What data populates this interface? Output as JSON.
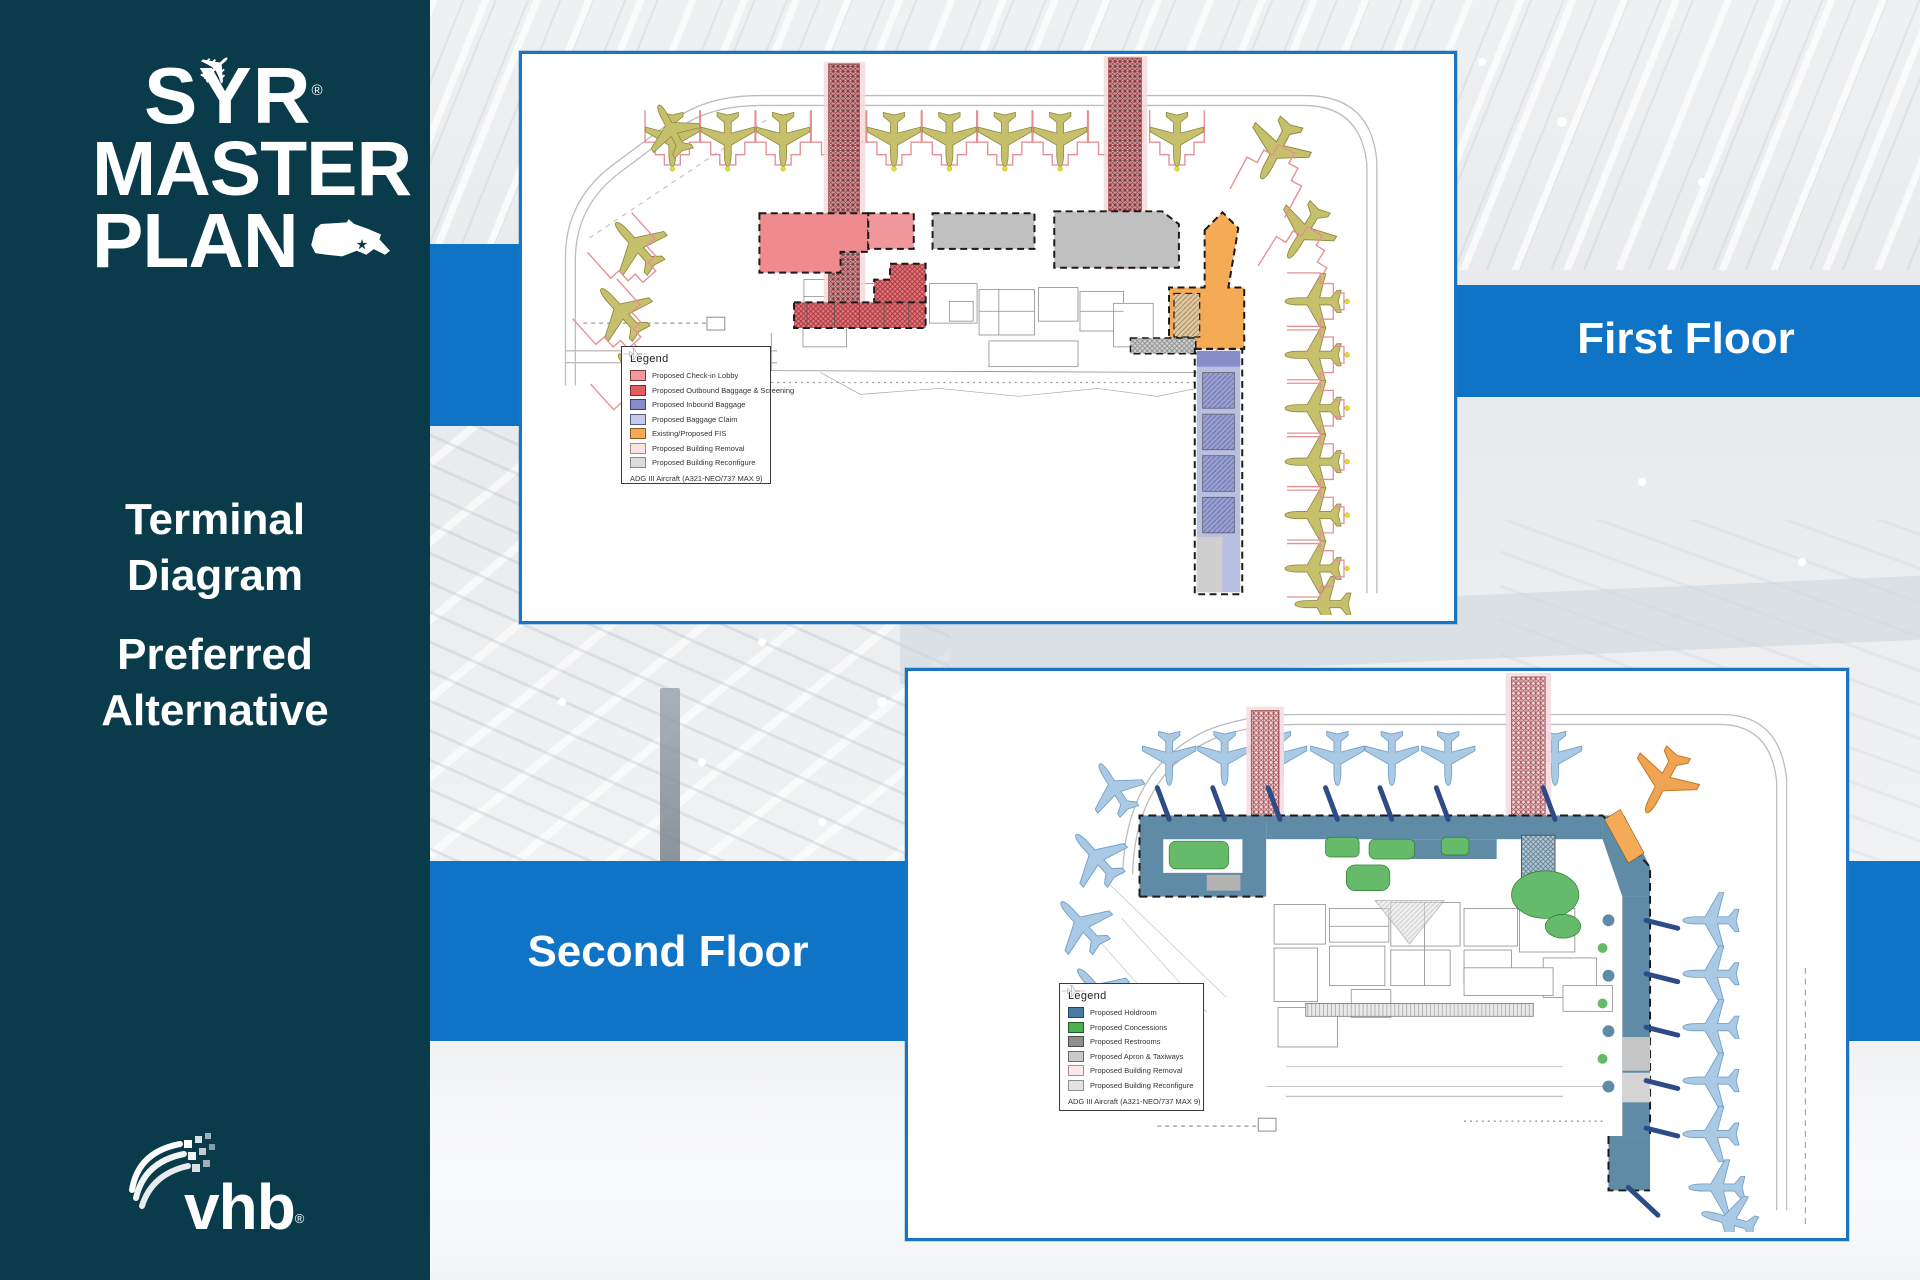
{
  "sidebar": {
    "logo": {
      "syr": "SYR",
      "master": "MASTER",
      "plan": "PLAN",
      "reg": "®",
      "plane_icon": "✈"
    },
    "title_line1": "Terminal",
    "title_line2": "Diagram",
    "subtitle_line1": "Preferred",
    "subtitle_line2": "Alternative",
    "vhb": "vhb",
    "vhb_reg": "®"
  },
  "bands": {
    "first": "First Floor",
    "second": "Second Floor"
  },
  "f1": {
    "title": "Legend",
    "items": [
      {
        "label": "Proposed Check-in Lobby",
        "fill": "#f0989c",
        "stroke": "#7a3b3d"
      },
      {
        "label": "Proposed Outbound Baggage & Screening",
        "fill": "#e25d60",
        "stroke": "#7a2d2f"
      },
      {
        "label": "Proposed Inbound Baggage",
        "fill": "#868dc9",
        "stroke": "#3c4277"
      },
      {
        "label": "Proposed Baggage Claim",
        "fill": "#c6cbe7",
        "stroke": "#565b86"
      },
      {
        "label": "Existing/Proposed FIS",
        "fill": "#f5ab56",
        "stroke": "#8a5a1e"
      },
      {
        "label": "Proposed Building Removal",
        "fill": "#f9e4e4",
        "stroke": "#a98a8a"
      },
      {
        "label": "Proposed Building Reconfigure",
        "fill": "#dcdcdc",
        "stroke": "#8a8a8a"
      }
    ],
    "aircraft_note": "ADG III Aircraft (A321-NEO/737 MAX 9)"
  },
  "f2": {
    "title": "Legend",
    "items": [
      {
        "label": "Proposed Holdroom",
        "fill": "#4a7ba6",
        "stroke": "#23456a"
      },
      {
        "label": "Proposed Concessions",
        "fill": "#4caf50",
        "stroke": "#1e5c23"
      },
      {
        "label": "Proposed Restrooms",
        "fill": "#8f8f8f",
        "stroke": "#4a4a4a"
      },
      {
        "label": "Proposed Apron & Taxiways",
        "fill": "#c9c9c9",
        "stroke": "#6a6a6a"
      },
      {
        "label": "Proposed Building Removal",
        "fill": "#fbe9e9",
        "stroke": "#ab8c8c"
      },
      {
        "label": "Proposed Building Reconfigure",
        "fill": "#e3e3e3",
        "stroke": "#8f8f8f"
      }
    ],
    "aircraft_note": "ADG III Aircraft (A321-NEO/737 MAX 9)"
  },
  "colors": {
    "sidebar_teal": "#0a3b4a",
    "band_blue": "#0f73c6",
    "panel_border": "#1b74c2",
    "holdroom_band": "#5f8ba6",
    "concessions_green": "#66bb6a",
    "jetbridge_navy": "#2d4b86",
    "aircraft_floor1": "#c6c06d",
    "aircraft_floor2": "#a9c9e4",
    "orange_aircraft": "#f0a350",
    "fis_orange": "#f5ab56",
    "checkin_salmon": "#ef8a8e",
    "background_photo": "#e9ebee"
  }
}
